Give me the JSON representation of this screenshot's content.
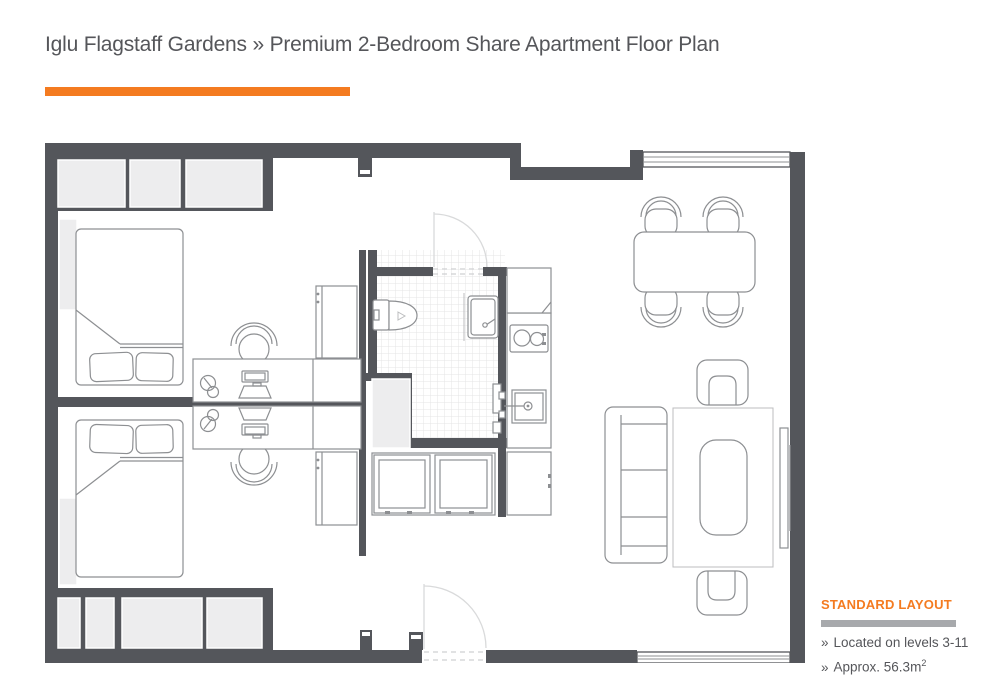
{
  "header": {
    "title": "Iglu Flagstaff Gardens » Premium 2-Bedroom Share Apartment Floor Plan"
  },
  "legend": {
    "heading": "STANDARD LAYOUT",
    "items": [
      {
        "bullet": "»",
        "text": "Located on levels 3-11",
        "superscript": ""
      },
      {
        "bullet": "»",
        "text": "Approx. 56.3m",
        "superscript": "2"
      }
    ]
  },
  "colors": {
    "accent": "#F47B20",
    "wall": "#54565B",
    "text": "#55565A",
    "line": "#8D8F92",
    "panel": "#EDEDEE",
    "divider": "#A7A9AC"
  }
}
